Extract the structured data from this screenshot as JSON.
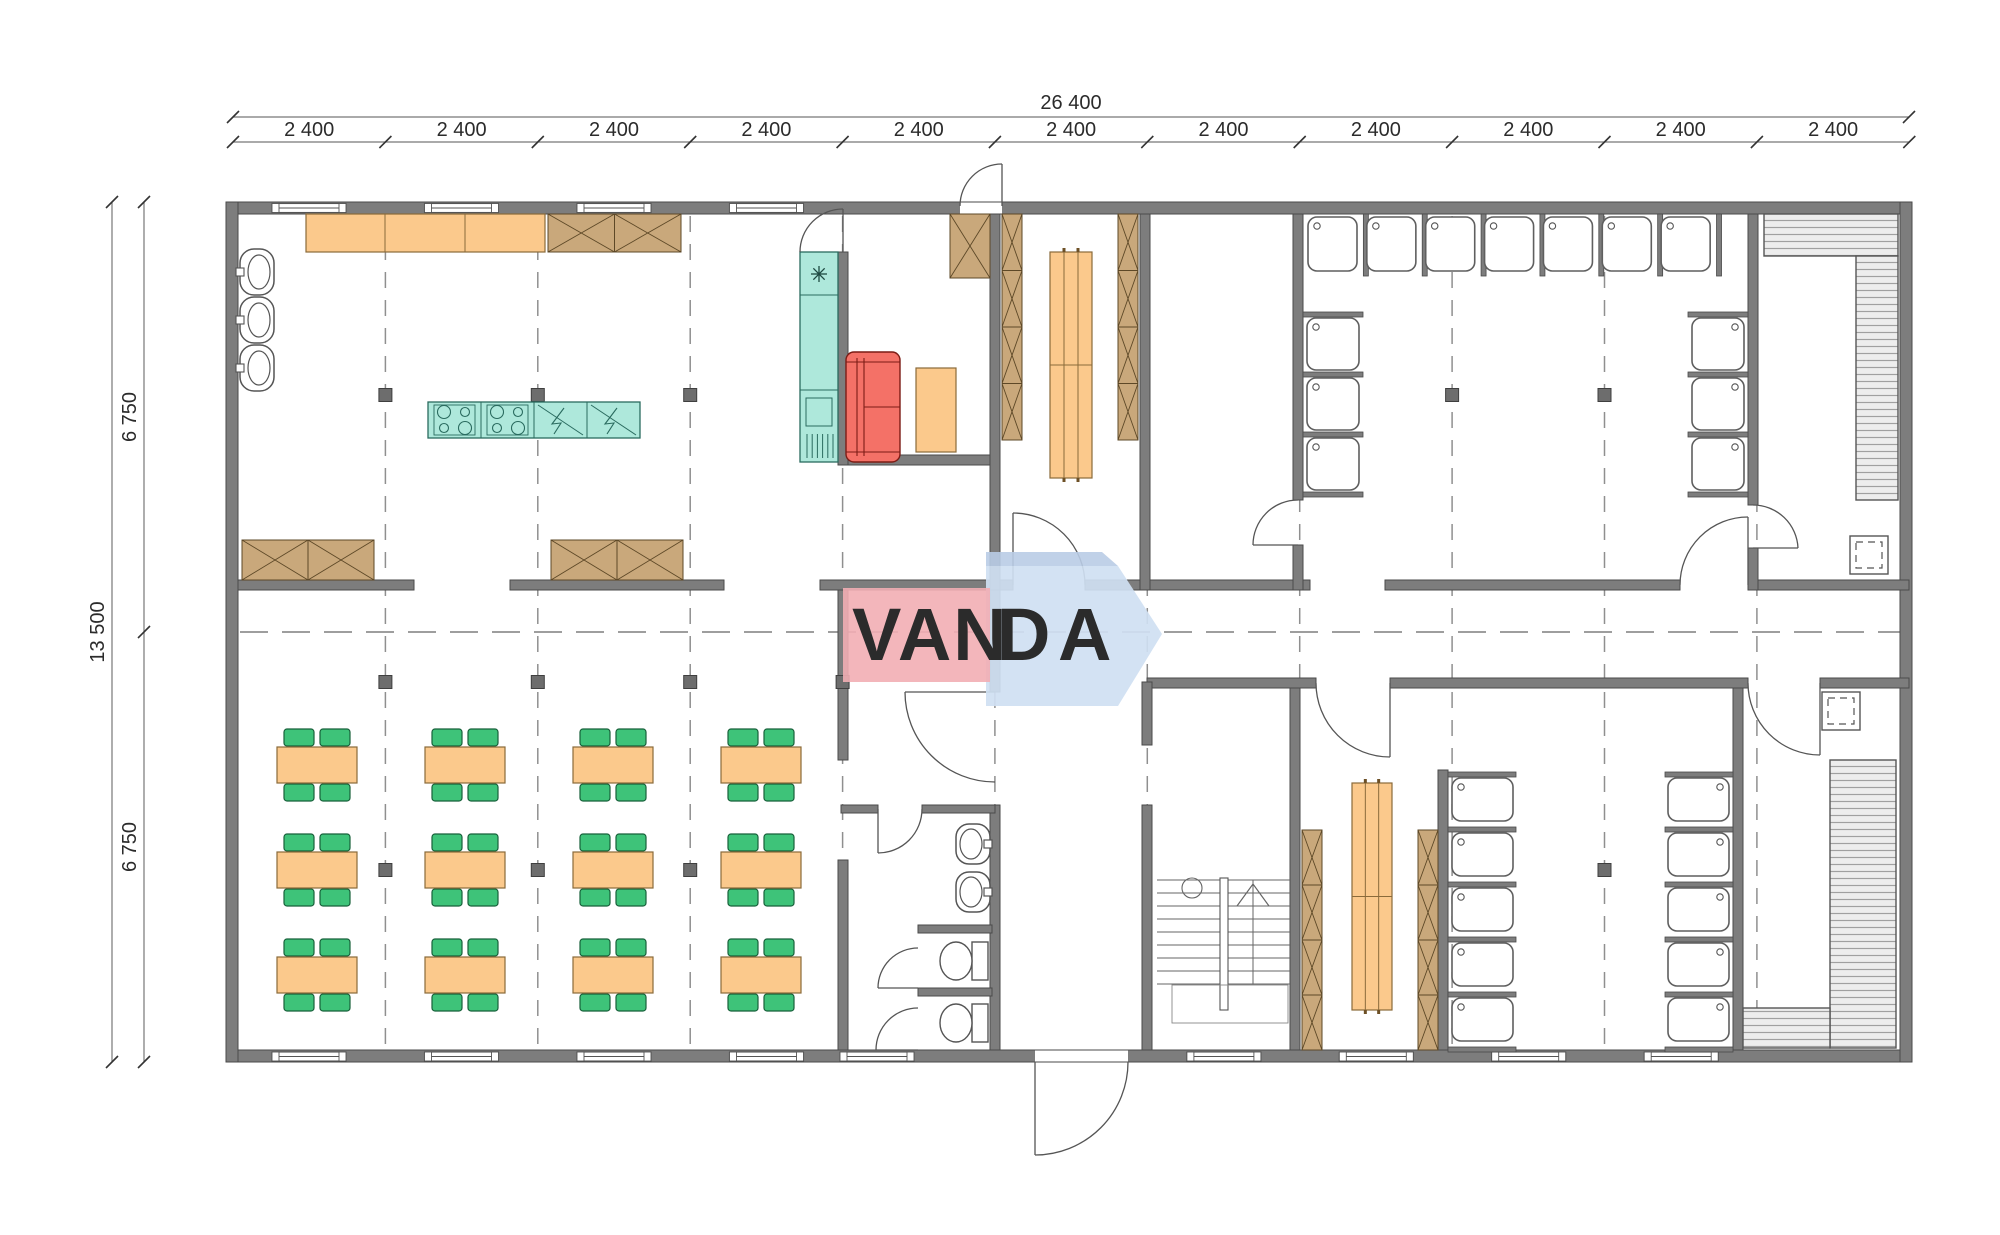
{
  "title": "floor-plan-drawing",
  "dimensions": {
    "total_width": "26 400",
    "bay_label": "2 400",
    "bay_count": 11,
    "total_height": "13 500",
    "half_height": "6 750"
  },
  "watermark": {
    "text": "VANDA",
    "part_white": "VAN",
    "part_white2": "D",
    "part_blue": "A",
    "pink": "#f2aeb4",
    "blue_light": "#cfe0f2",
    "blue_band": "#b9cce6",
    "letter_blue": "#b4c3e8"
  },
  "palette": {
    "wall": "#7d7d7d",
    "wall_edge": "#4a4a4a",
    "counter_orange": "#fbc98c",
    "cabinet_brown": "#c9a87b",
    "cabinet_line": "#5d4827",
    "appliance_teal": "#aee8db",
    "teal_line": "#2a6b5f",
    "sofa_red": "#f47167",
    "chair_green": "#3ec379",
    "grid_dash": "#8f8f8f",
    "bench_hatch": "#ededed"
  },
  "counts": {
    "dining_tables": 12,
    "chairs_per_table": 4,
    "showers_top_room": 13,
    "showers_bottom_room": 10,
    "kitchen_wall_sinks": 3,
    "wc_sinks": 2,
    "toilets": 2,
    "saunas": 2,
    "stair_flights": 1
  }
}
